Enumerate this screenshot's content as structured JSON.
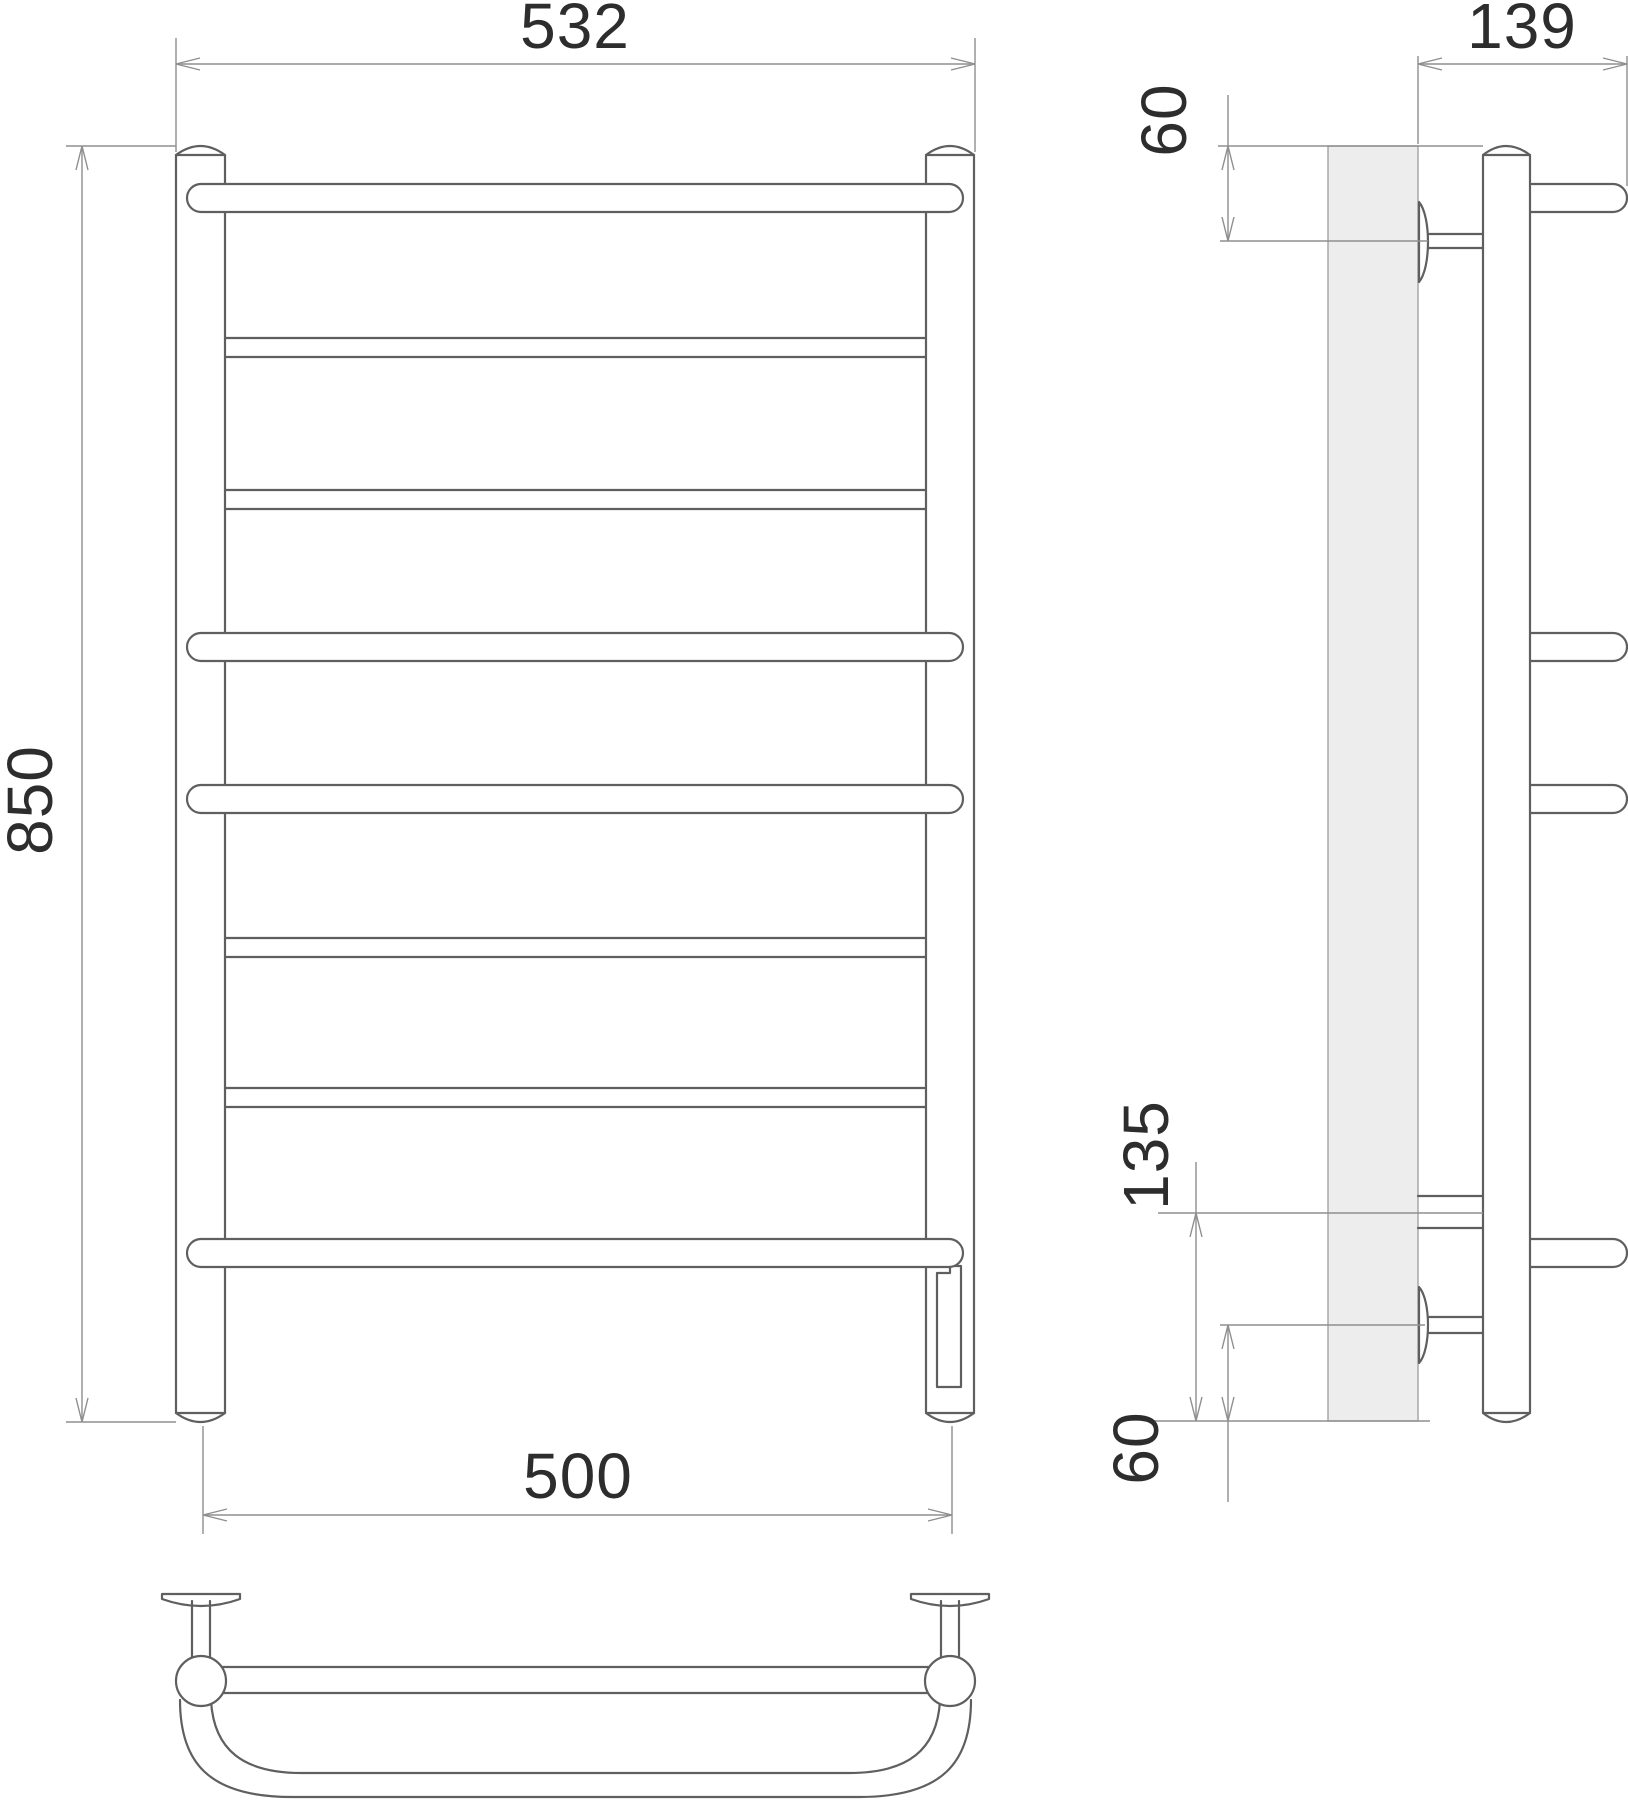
{
  "drawing": {
    "type": "technical-drawing",
    "subject": "ladder towel rail with 8 bars, wall brackets and electric heating element",
    "background": "#ffffff",
    "colors": {
      "object_line": "#5f5f5f",
      "dimension_line": "#8f8f8f",
      "text": "#2d2d2d",
      "wall_fill": "#ededed"
    },
    "views": {
      "front": {
        "label": "front-view",
        "dimensions": {
          "overall_width": "532",
          "overall_height": "850",
          "mount_center_width": "500"
        }
      },
      "side": {
        "label": "side-view",
        "dimensions": {
          "overall_depth": "139",
          "top_bracket_offset": "60",
          "bottom_connection_height": "135",
          "bottom_bracket_offset": "60"
        }
      },
      "bottom": {
        "label": "bottom-view"
      }
    }
  }
}
